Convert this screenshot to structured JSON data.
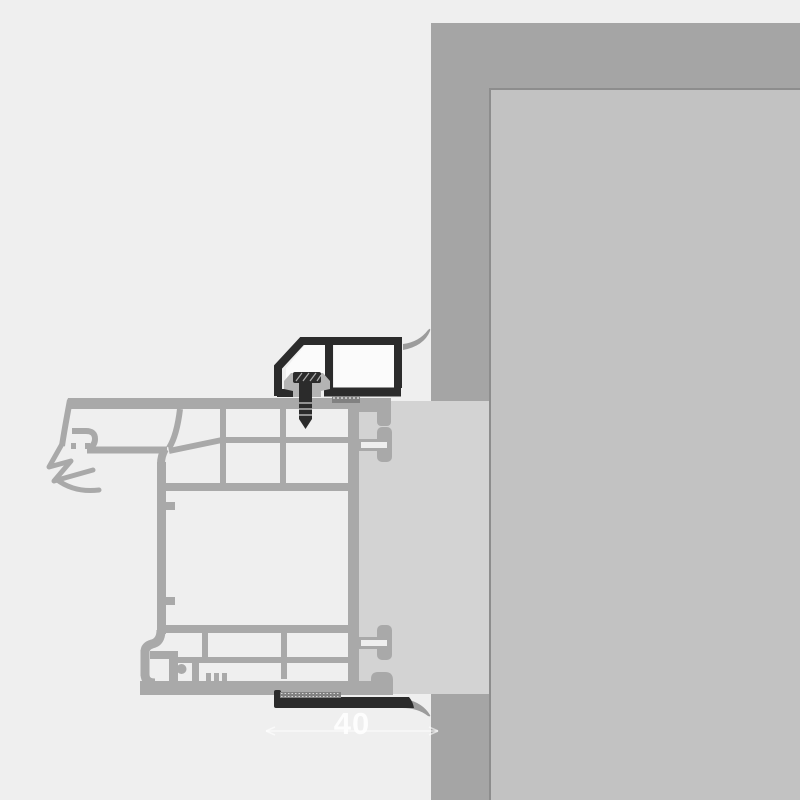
{
  "figure": {
    "alt": "Technical cross-section detail: PVC window frame profile fixed to a masonry wall reveal with mounting bracket, fixing screw, compression tapes and sealing membranes",
    "dimension": {
      "label": "40"
    }
  },
  "colors": {
    "bg": "#efefef",
    "wallOuter": "#a5a5a5",
    "wallInner": "#c2c2c2",
    "wallEdge": "#8d8d8d",
    "filler": "#d3d3d3",
    "profile": "#a9a9a9",
    "membrane": "#9c9c9c",
    "dark": "#2b2b2b",
    "chamber": "#fbfbfb",
    "clip": "#b4b4b4",
    "tape": "#818181",
    "tapeDots": "#d9d9d9",
    "watermark": "rgba(255,255,255,0.85)",
    "watermarkLine": "rgba(255,255,255,0.6)"
  }
}
